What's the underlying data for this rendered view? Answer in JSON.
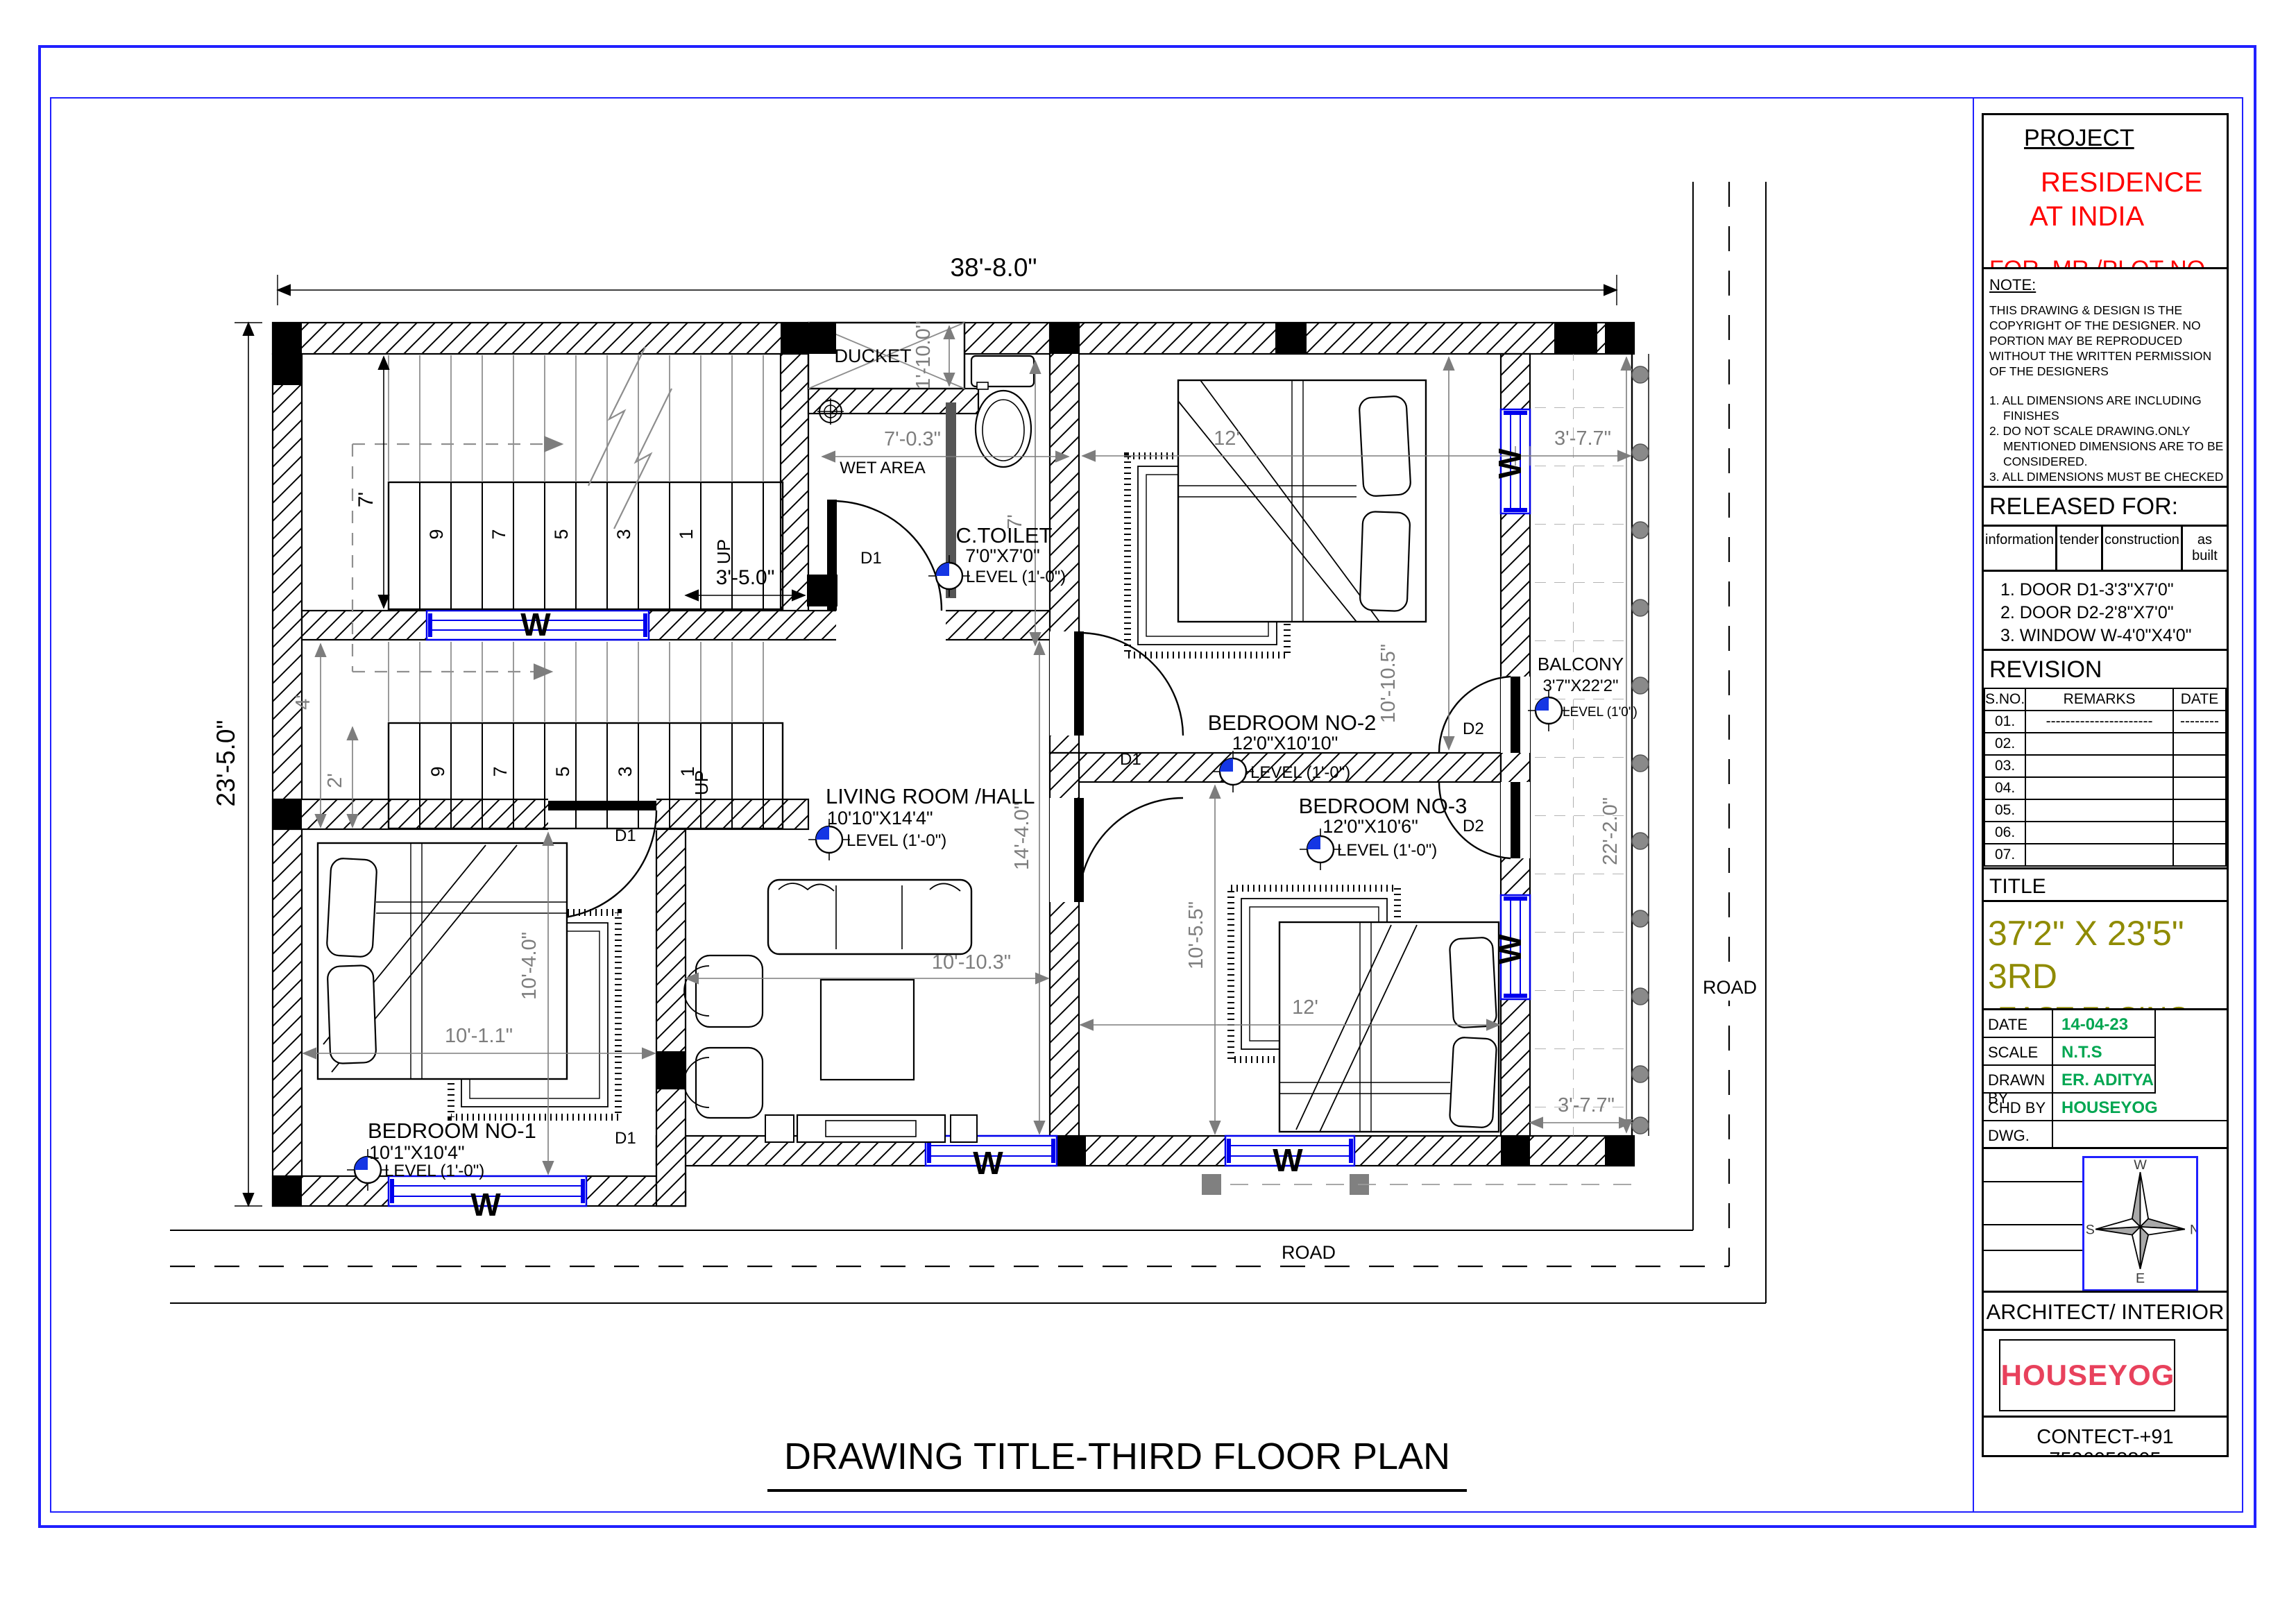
{
  "colors": {
    "border_blue": "#2020ff",
    "window_blue": "#0000ee",
    "dim_gray": "#7d7d7d",
    "red": "#ff0000",
    "value_green": "#00a651",
    "title_olive": "#8f8b00",
    "logo_red": "#e8415c",
    "logo_teal": "#2a8f8f",
    "level_blue": "#1536e4"
  },
  "plan": {
    "sheet_title": "DRAWING TITLE-THIRD FLOOR PLAN",
    "road_label": "ROAD",
    "window_label": "W",
    "up_label": "UP",
    "treads": [
      "9",
      "7",
      "5",
      "3",
      "1"
    ],
    "doors": {
      "d1": "D1",
      "d2": "D2"
    },
    "overall": {
      "width": "38'-8.0\"",
      "height": "23'-5.0\""
    },
    "dims": {
      "stair_width": "7'",
      "stair_clear": "3'-5.0\"",
      "landing_upper": "4'",
      "landing_lower": "2'",
      "ducket_depth": "1'-10.0\"",
      "wet_width": "7'-0.3\"",
      "toilet_height": "7'",
      "bed2_width": "12'",
      "bed2_height": "10'-10.5\"",
      "balcony_top": "3'-7.7\"",
      "balcony_bottom": "3'-7.7\"",
      "balcony_height": "22'-2.0\"",
      "living_width": "10'-10.3\"",
      "living_height": "14'-4.0\"",
      "bed1_width": "10'-1.1\"",
      "bed1_height": "10'-4.0\"",
      "bed3_width": "12'",
      "bed3_height": "10'-5.5\""
    },
    "rooms": {
      "ducket": {
        "name": "DUCKET"
      },
      "wet": {
        "name": "WET AREA"
      },
      "toilet": {
        "name": "C.TOILET",
        "size": "7'0\"X7'0\"",
        "level": "LEVEL (1'-0\")"
      },
      "bedroom2": {
        "name": "BEDROOM NO-2",
        "size": "12'0\"X10'10\"",
        "level": "LEVEL (1'-0\")"
      },
      "balcony": {
        "name": "BALCONY",
        "size": "3'7\"X22'2\"",
        "level": "LEVEL (1'0\")"
      },
      "living": {
        "name": "LIVING ROOM /HALL",
        "size": "10'10\"X14'4\"",
        "level": "LEVEL (1'-0\")"
      },
      "bedroom1": {
        "name": "BEDROOM NO-1",
        "size": "10'1\"X10'4\"",
        "level": "LEVEL (1'-0\")"
      },
      "bedroom3": {
        "name": "BEDROOM NO-3",
        "size": "12'0\"X10'6\"",
        "level": "LEVEL (1'-0\")"
      }
    }
  },
  "titleblock": {
    "project_heading": "PROJECT",
    "project_name_line1": "RESIDENCE",
    "project_name_line2": "AT INDIA",
    "for_line": "FOR. MR  /PLOT NO.",
    "note_heading": "NOTE:",
    "note_body": "THIS DRAWING & DESIGN IS THE COPYRIGHT OF THE DESIGNER. NO PORTION MAY BE REPRODUCED WITHOUT THE WRITTEN PERMISSION OF THE DESIGNERS",
    "notes": [
      "1. ALL DIMENSIONS ARE INCLUDING FINISHES",
      "2. DO NOT SCALE DRAWING.ONLY MENTIONED DIMENSIONS ARE TO BE CONSIDERED.",
      "3. ALL DIMENSIONS MUST BE CHECKED BEFORE COMMENCING WORK ON SITE.",
      "4. ANY DISCREPANCIES SHALL BE BROUGHT UNDER THE NOTICE OF ARCHITECTS PRIOR COMMENCEMENT OF WORK."
    ],
    "released_heading": "RELEASED FOR:",
    "released_options": [
      "information",
      "tender",
      "construction",
      "as built"
    ],
    "schedule": [
      "1.  DOOR D1-3'3\"X7'0\"",
      "2. DOOR D2-2'8\"X7'0\"",
      "3. WINDOW W-4'0\"X4'0\"",
      "4. VANTILATOR V-2'0\"X1'6\"",
      "5. DOOR D-5'X7'"
    ],
    "revision_heading": "REVISION",
    "revision_cols": [
      "S.NO.",
      "REMARKS",
      "DATE"
    ],
    "revision_rows": [
      [
        "01.",
        "----------------------",
        "--------"
      ],
      [
        "02.",
        "",
        ""
      ],
      [
        "03.",
        "",
        ""
      ],
      [
        "04.",
        "",
        ""
      ],
      [
        "05.",
        "",
        ""
      ],
      [
        "06.",
        "",
        ""
      ],
      [
        "07.",
        "",
        ""
      ]
    ],
    "title_label": "TITLE",
    "drawing_size": "37'2\" X 23'5\"",
    "floor": "3RD",
    "facing": "EAST  FACING",
    "meta": [
      {
        "label": "DATE",
        "value": "14-04-23"
      },
      {
        "label": "SCALE",
        "value": "N.T.S"
      },
      {
        "label": "DRAWN  BY",
        "value": "ER. ADITYA KUMAR"
      },
      {
        "label": "CHD BY",
        "value": "HOUSEYOG"
      },
      {
        "label": "DWG. NO.",
        "value": ""
      }
    ],
    "compass": {
      "w": "W",
      "n": "N",
      "s": "S",
      "e": "E"
    },
    "architect_heading": "ARCHITECT/ INTERIOR DESIGN",
    "logo_text": "HOUSEYOG",
    "contact": "CONTECT-+91 7596058805"
  }
}
